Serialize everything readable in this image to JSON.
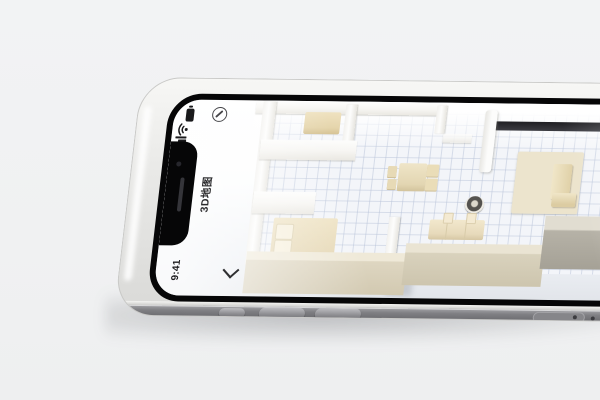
{
  "scene": {
    "description": "silver smartphone lying flat in landscape showing a 3D apartment map app",
    "background_color": "#f1f2f3"
  },
  "device": {
    "status_bar": {
      "time": "9:41",
      "icons": [
        "battery-icon",
        "wifi-icon",
        "signal-icon"
      ]
    },
    "app_bar": {
      "title": "3D地图",
      "back_icon": "chevron-back-icon",
      "action_icon": "compass-icon"
    },
    "hardware": {
      "buttons": [
        "mute-switch",
        "volume-up-button",
        "volume-down-button",
        "sim-tray"
      ],
      "frame_color": "#e9e9e7",
      "side_color": "#7f7f83"
    }
  },
  "floorplan": {
    "label": "3D apartment floor map",
    "furniture": [
      "bench",
      "bed",
      "pillow",
      "pillow",
      "dining-table",
      "chair",
      "chair",
      "chair",
      "chair",
      "robot-vacuum",
      "tv-cabinet",
      "rug",
      "sofa",
      "open-door",
      "window"
    ],
    "colors": {
      "wall_top": "#fdfdfc",
      "wall_front": "#d2c9b1",
      "floor": "#f3f5f9",
      "grid": "#b7c2d8",
      "furniture": "#e9dcb8",
      "window": "#2a2a2e"
    }
  }
}
